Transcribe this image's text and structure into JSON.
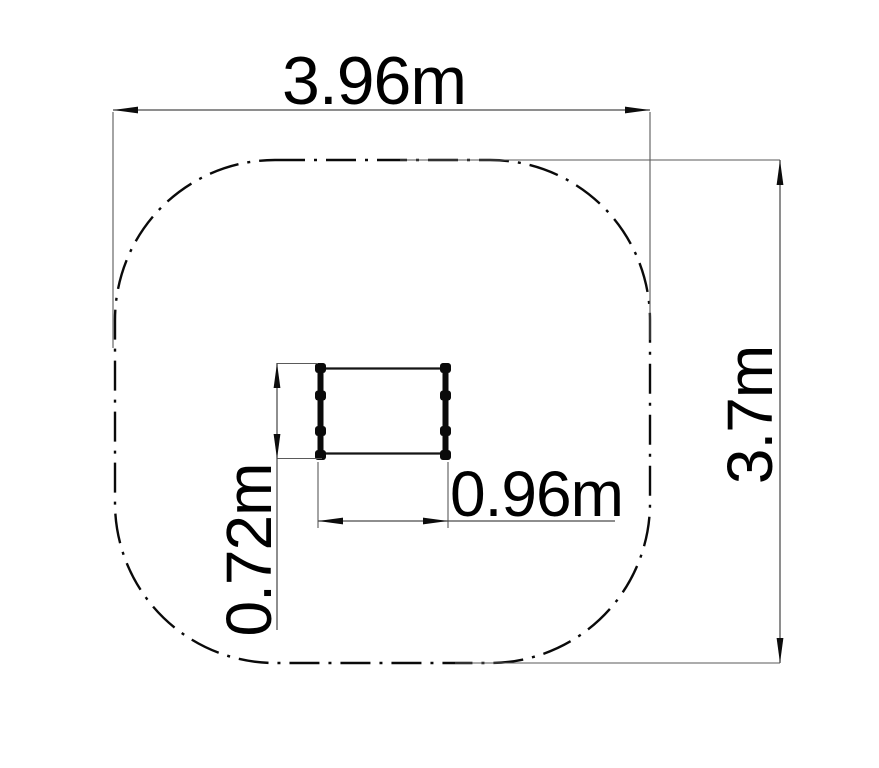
{
  "drawing": {
    "background_color": "#ffffff",
    "line_color": "#0a0a0a",
    "dimension_line_color": "#4a4a4a",
    "text_color": "#000000",
    "dimensions": {
      "overall_width": "3.96m",
      "overall_height": "3.7m",
      "item_width": "0.96m",
      "item_height": "0.72m"
    }
  }
}
